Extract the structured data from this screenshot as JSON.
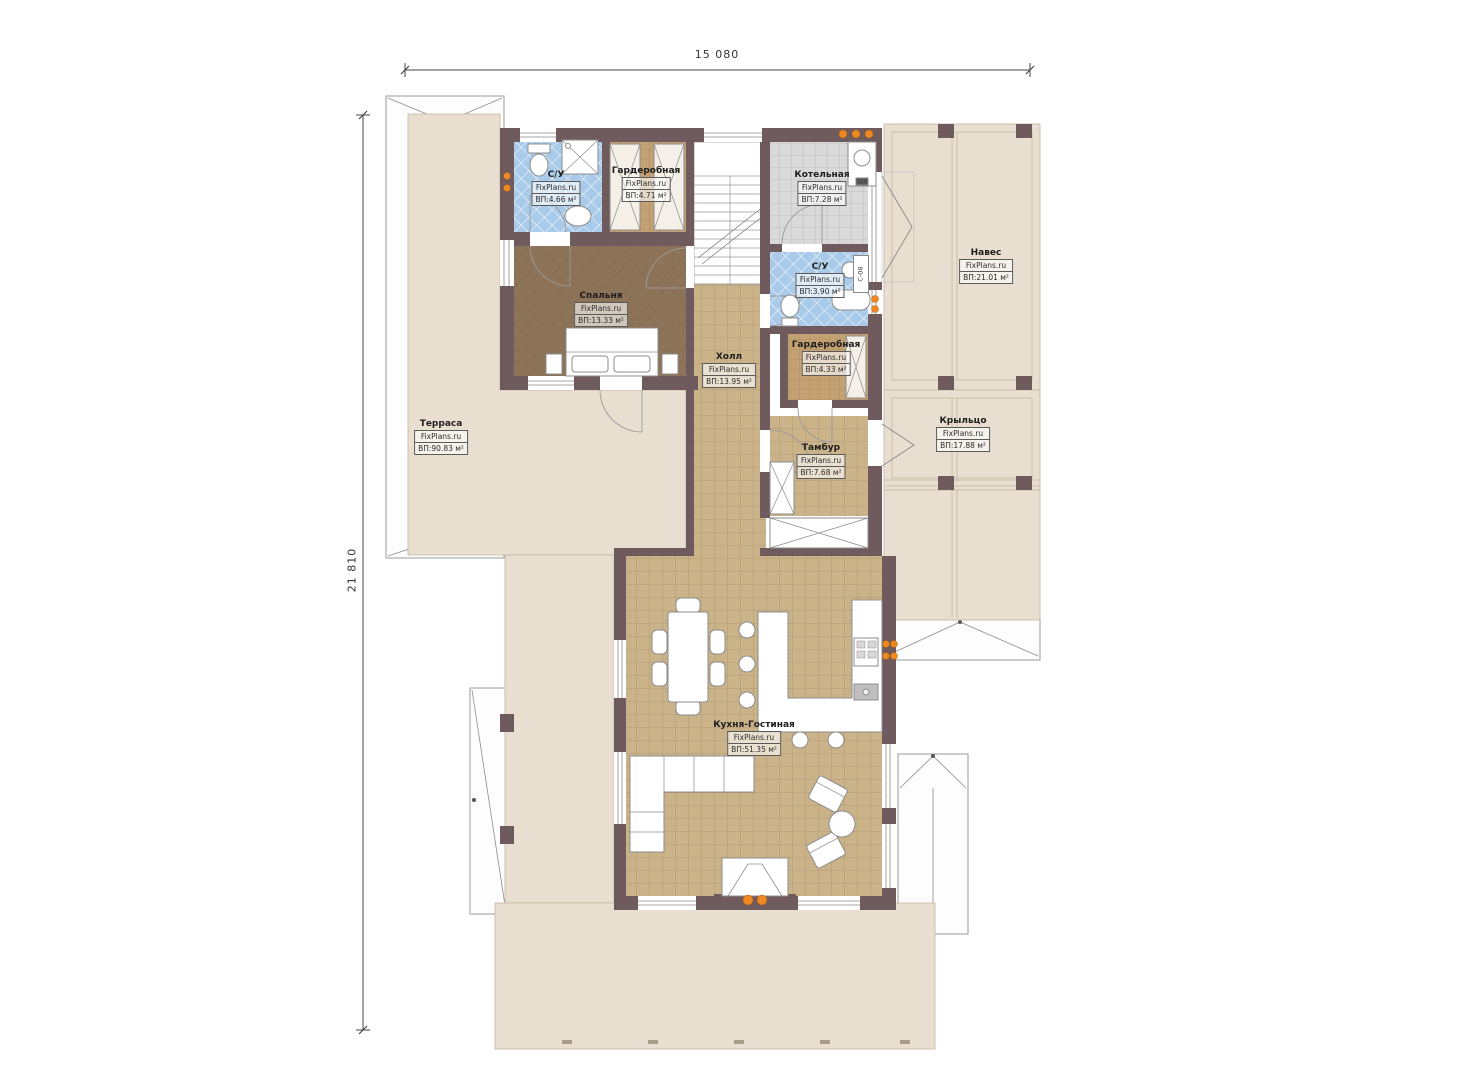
{
  "plan": {
    "title": "План первого этажа",
    "dim_width": "15 080",
    "dim_height": "21 810",
    "watermark": "FixPlans.ru",
    "door_tag": "С-08",
    "rooms": [
      {
        "id": "su-1",
        "name": "С/У",
        "area": "ВП:4.66 м²"
      },
      {
        "id": "wardrobe-1",
        "name": "Гардеробная",
        "area": "ВП:4.71 м²"
      },
      {
        "id": "boiler",
        "name": "Котельная",
        "area": "ВП:7.28 м²"
      },
      {
        "id": "canopy",
        "name": "Навес",
        "area": "ВП:21.01 м²"
      },
      {
        "id": "su-2",
        "name": "С/У",
        "area": "ВП:3.90 м²"
      },
      {
        "id": "bedroom",
        "name": "Спальня",
        "area": "ВП:13.33 м²"
      },
      {
        "id": "wardrobe-2",
        "name": "Гардеробная",
        "area": "ВП:4.33 м²"
      },
      {
        "id": "hall",
        "name": "Холл",
        "area": "ВП:13.95 м²"
      },
      {
        "id": "terrace",
        "name": "Терраса",
        "area": "ВП:90.83 м²"
      },
      {
        "id": "porch",
        "name": "Крыльцо",
        "area": "ВП:17.88 м²"
      },
      {
        "id": "vestibule",
        "name": "Тамбур",
        "area": "ВП:7.68 м²"
      },
      {
        "id": "kitchen-living",
        "name": "Кухня-Гостиная",
        "area": "ВП:51.35 м²"
      }
    ],
    "colors": {
      "wall": "#6f5a5e",
      "tile_floor": "#cbb389",
      "bedroom_floor": "#8d7458",
      "wet_tile": "#a9cbe9",
      "boiler_tile": "#d9d9d9",
      "outdoor": "#e9dfd0",
      "accent_orange": "#ee8822"
    }
  }
}
